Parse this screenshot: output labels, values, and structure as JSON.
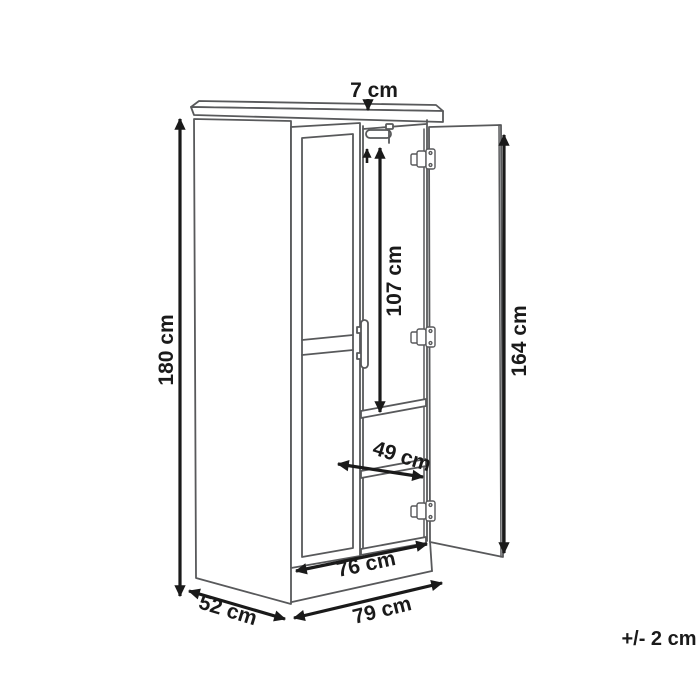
{
  "figure": {
    "kind": "furniture-dimension-line-drawing",
    "subject": "two-door wardrobe with open right door, clothes rail, shelves and plinth",
    "parts": [
      "left side panel",
      "top board",
      "closed left door with recessed panels and vertical bar handle",
      "open right door with three hinges",
      "clothes rail",
      "two interior shelves",
      "plinth base"
    ],
    "colors": {
      "background": "#ffffff",
      "line_art": "#58595b",
      "dimension": "#1a1a1a"
    },
    "icons": {
      "hinge": "cabinet-hinge-icon",
      "rail": "clothes-rail-icon",
      "handle": "door-handle-icon"
    }
  },
  "dimensions": {
    "top_gap": "7 cm",
    "total_height": "180 cm",
    "hanging_height": "107 cm",
    "door_height": "164 cm",
    "shelf_width": "49 cm",
    "interior_width": "76 cm",
    "depth": "52 cm",
    "total_width": "79 cm"
  },
  "tolerance": "+/- 2 cm"
}
